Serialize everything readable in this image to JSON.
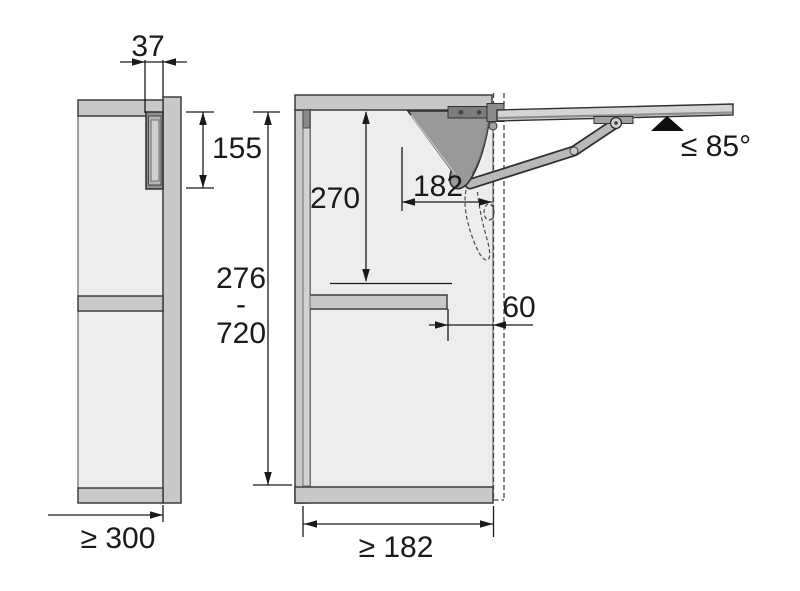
{
  "figure": {
    "kind": "cabinet lift-up flap fitting installation drawing",
    "left_view": {
      "dim_fitting_offset": "37",
      "dim_fitting_height": "155",
      "dim_min_cabinet_depth": "≥ 300"
    },
    "right_view": {
      "dim_pivot_drop": "270",
      "dim_fitting_reach": "182",
      "dim_cabinet_height_min": "276",
      "dim_range_separator": "-",
      "dim_cabinet_height_max": "720",
      "dim_shelf_setback": "60",
      "dim_min_inner_depth": "≥ 182",
      "dim_max_opening_angle": "≤ 85°"
    },
    "colors": {
      "panel": "#c8c8c8",
      "interior": "#ededed",
      "mechanism": "#999999",
      "arm": "#b9b9b9",
      "flap": "#d4d4d4",
      "outline": "#2f2f2f",
      "dimension": "#1a1a1a",
      "marker": "#0d0d0d"
    }
  }
}
